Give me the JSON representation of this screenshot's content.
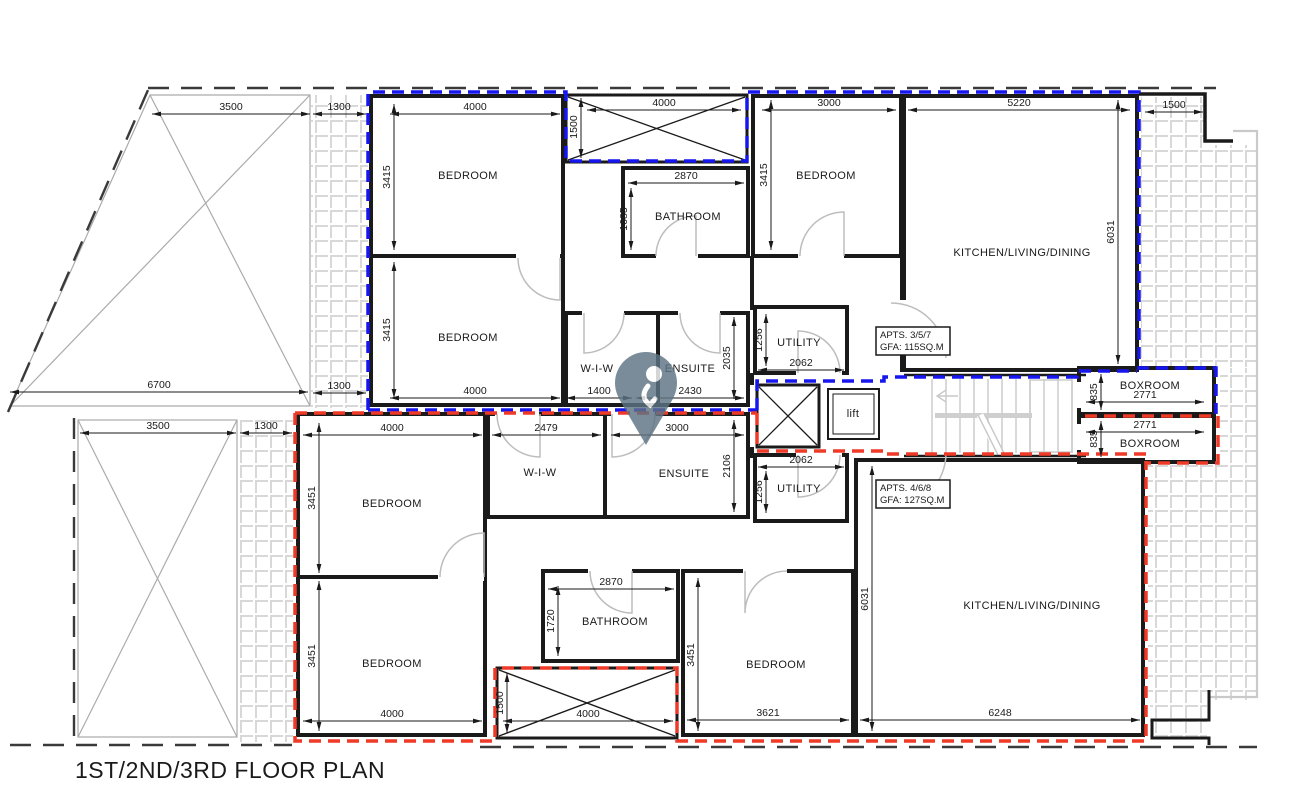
{
  "title": "1ST/2ND/3RD FLOOR PLAN",
  "apartments": {
    "upper": {
      "name": "APTS. 3/5/7",
      "gfa": "GFA: 115SQ.M",
      "boundary_color": "#1616ef"
    },
    "lower": {
      "name": "APTS. 4/6/8",
      "gfa": "GFA: 127SQ.M",
      "boundary_color": "#ef3a28"
    }
  },
  "rooms": [
    "BEDROOM",
    "BATHROOM",
    "BEDROOM",
    "KITCHEN/LIVING/DINING",
    "BEDROOM",
    "W-I-W",
    "ENSUITE",
    "UTILITY",
    "lift",
    "BOXROOM",
    "BOXROOM",
    "BEDROOM",
    "W-I-W",
    "ENSUITE",
    "UTILITY",
    "BEDROOM",
    "BATHROOM",
    "BEDROOM",
    "KITCHEN/LIVING/DINING"
  ],
  "dims": [
    "3500",
    "1300",
    "4000",
    "1500",
    "4000",
    "3000",
    "5220",
    "1500",
    "3415",
    "2870",
    "1685",
    "3415",
    "6031",
    "3415",
    "6700",
    "1300",
    "4000",
    "1400",
    "2430",
    "2035",
    "1256",
    "2062",
    "835",
    "2771",
    "2771",
    "835",
    "3500",
    "1300",
    "4000",
    "2479",
    "3000",
    "2106",
    "1256",
    "2062",
    "3451",
    "2870",
    "1720",
    "3451",
    "3451",
    "6031",
    "1500",
    "4000",
    "4000",
    "3621",
    "6248"
  ],
  "colors": {
    "walls": "#1a1a1a",
    "terrace_lines": "#ababab",
    "hatch": "#d8d8d8",
    "stairs": "#c9c9c9",
    "doors": "#bdbdbd",
    "pin": "#5d7383"
  }
}
